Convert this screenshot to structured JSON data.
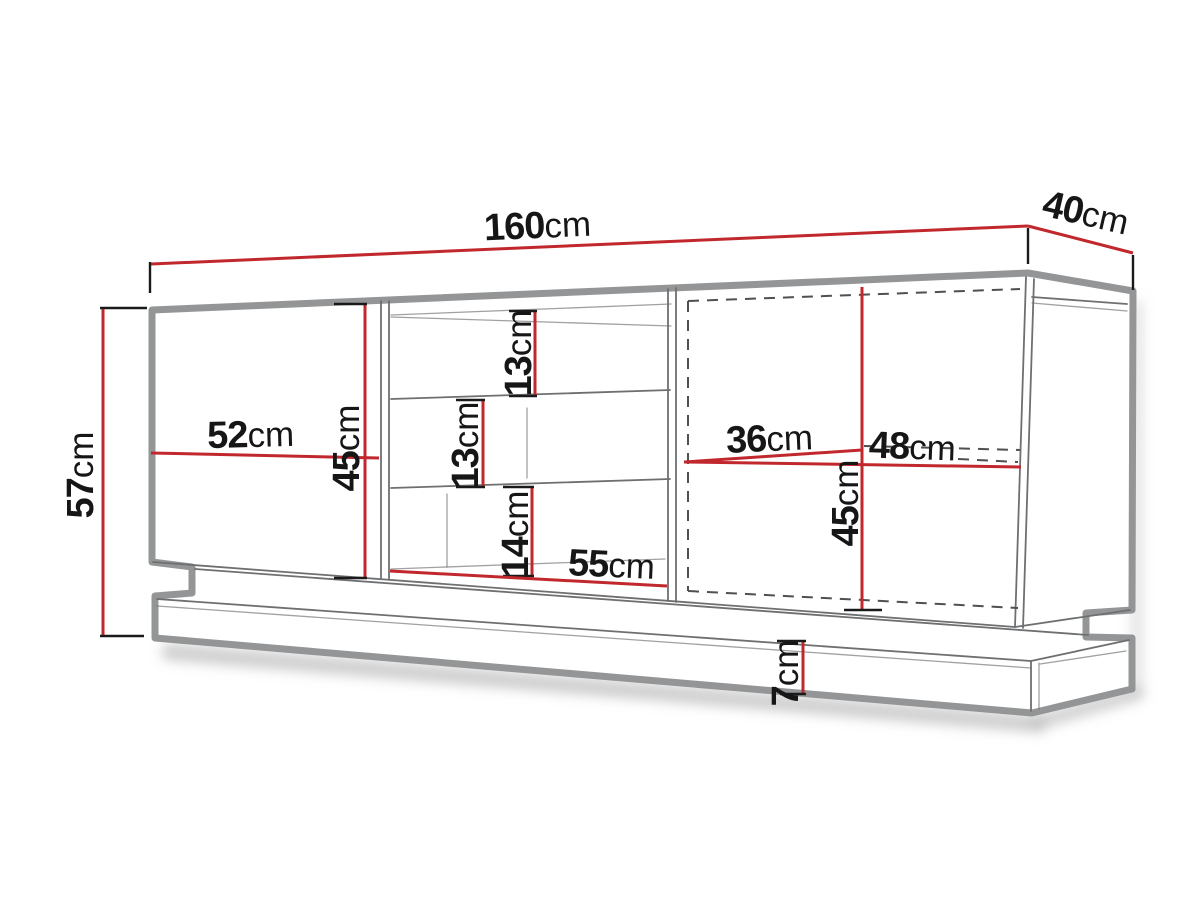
{
  "colors": {
    "dimension_line": "#c1282e",
    "tick": "#1a1a1a",
    "label_text": "#161616",
    "outline": "#939596",
    "detail_line": "#6e6f71",
    "dashed_line": "#4f5052",
    "shadow": "#bdbdbd",
    "background": "#ffffff"
  },
  "measurements": {
    "total_width": {
      "value": "160",
      "unit": "cm"
    },
    "total_depth": {
      "value": "40",
      "unit": "cm"
    },
    "total_height": {
      "value": "57",
      "unit": "cm"
    },
    "left_door_width": {
      "value": "52",
      "unit": "cm"
    },
    "left_door_height": {
      "value": "45",
      "unit": "cm"
    },
    "top_shelf_height": {
      "value": "13",
      "unit": "cm"
    },
    "middle_shelf_height": {
      "value": "13",
      "unit": "cm"
    },
    "bottom_shelf_height": {
      "value": "14",
      "unit": "cm"
    },
    "open_section_width": {
      "value": "55",
      "unit": "cm"
    },
    "right_door_width": {
      "value": "36",
      "unit": "cm"
    },
    "right_section_width": {
      "value": "48",
      "unit": "cm"
    },
    "right_door_height": {
      "value": "45",
      "unit": "cm"
    },
    "plinth_height": {
      "value": "7",
      "unit": "cm"
    }
  }
}
